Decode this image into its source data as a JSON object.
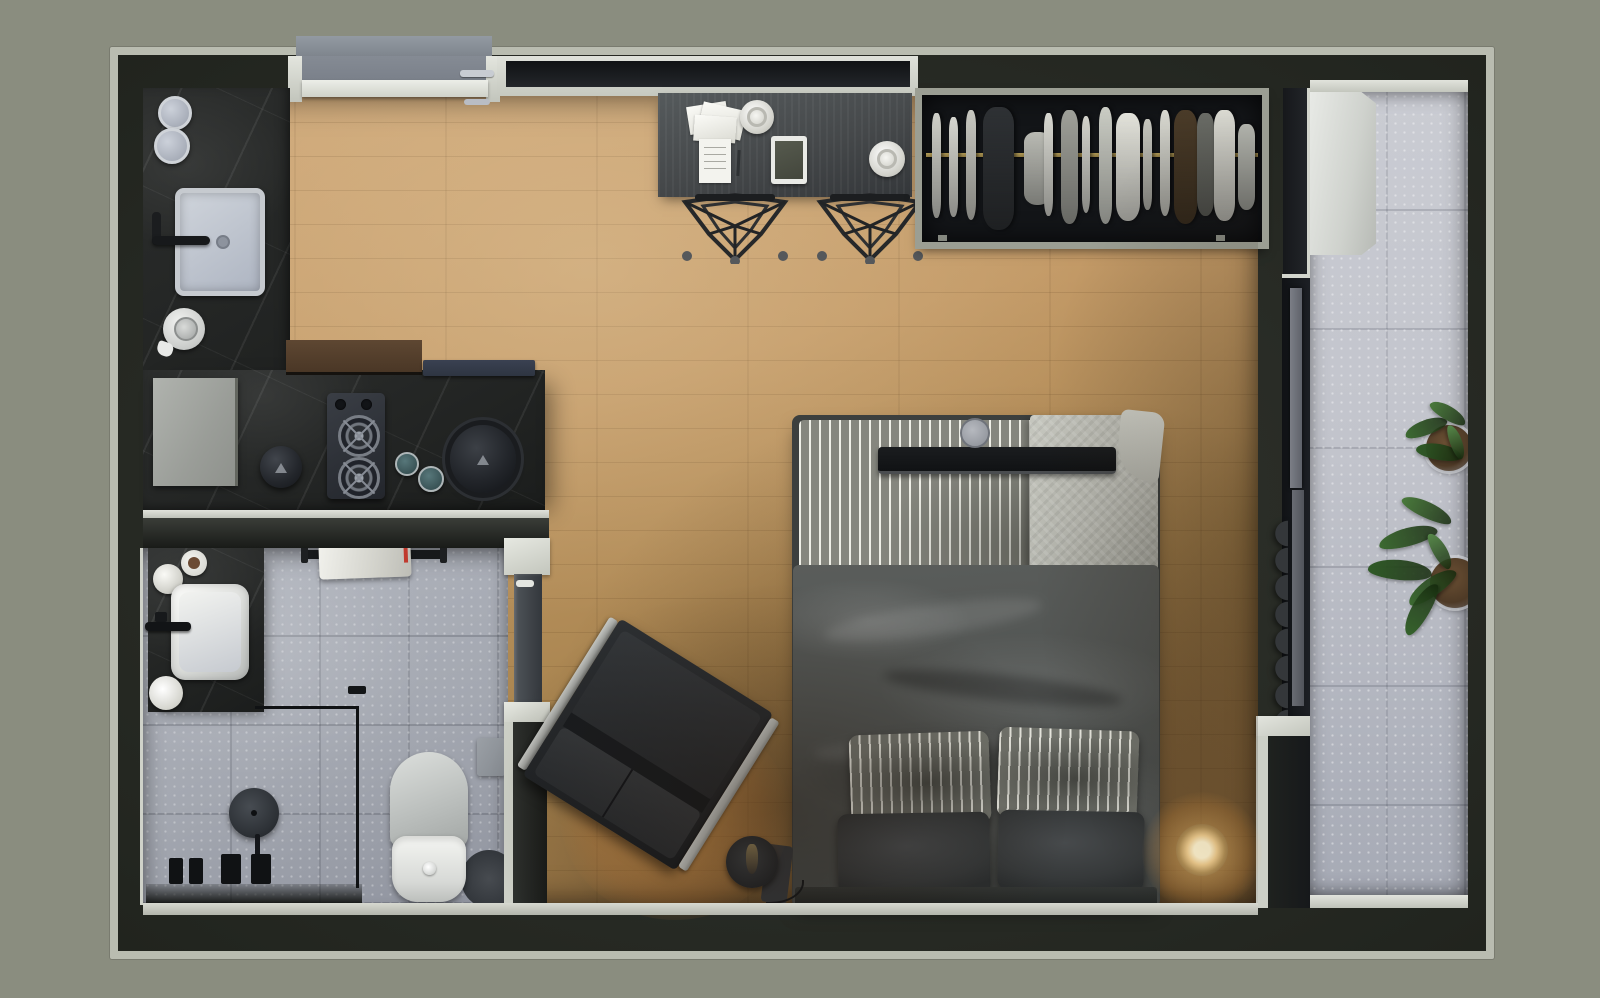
{
  "title": "Studio apartment floor plan — top-down 3D render",
  "palette": {
    "bg": "#8a8d7f",
    "trim": "#b9bcb0",
    "marble": "#232524",
    "marble_vein": "#ffffff12",
    "bath_tile": "#a4a8b1",
    "balc_tile": "#c2c4cc",
    "wood_a": "#cfa97a",
    "wood_b": "#a8844f",
    "wood_c": "#7d5f38",
    "desk": "#45484a",
    "navy": "#2e3542",
    "brass": "#8f7a42",
    "wardrobe_bg": "#131518",
    "duvet": "#4d504e",
    "sheet_light": "#eeeee6",
    "sheet_dark": "#85867e",
    "throw": "#b7b8b0",
    "pillow_dark": "#36393a",
    "leather": "#24272a",
    "metal": "#b3b5b1",
    "glow": "#ffcf7e",
    "soil": "#4e3a26",
    "red_tag": "#c03a2e"
  },
  "rooms": [
    {
      "id": "kitchen",
      "objects": [
        "marble-counter",
        "sink",
        "faucet",
        "cooktop-two-burners",
        "kettle",
        "canisters",
        "appliance",
        "serving-discs",
        "glasses"
      ]
    },
    {
      "id": "bathroom",
      "objects": [
        "marble-vanity",
        "vessel-sink",
        "black-faucet",
        "towel-rail",
        "towel",
        "walk-in-shower",
        "shower-head",
        "toilet",
        "toilet-rug",
        "paper-holder",
        "door"
      ]
    },
    {
      "id": "living-bedroom",
      "objects": [
        "desk",
        "papers",
        "coffee-cups",
        "notepad",
        "tablet",
        "two-wire-stools",
        "open-wardrobe",
        "hanging-clothes",
        "double-bed",
        "striped-sheet",
        "herringbone-throw",
        "bed-tray",
        "duvet",
        "four-pillows",
        "armchair",
        "floor-lamp",
        "table-lamp",
        "curtain",
        "sliding-glass-door"
      ]
    },
    {
      "id": "balcony",
      "objects": [
        "terrazzo-floor",
        "white-bench",
        "potted-plant",
        "potted-plant"
      ]
    },
    {
      "id": "entry",
      "objects": [
        "entry-door",
        "door-handles",
        "concrete-landing",
        "transom-window"
      ]
    }
  ],
  "wardrobe_clothes": [
    {
      "l": 3,
      "w": 2.5,
      "t": 12,
      "h": 72,
      "c": "#cfcfc8"
    },
    {
      "l": 8,
      "w": 2.5,
      "t": 15,
      "h": 68,
      "c": "#d6d6cf"
    },
    {
      "l": 13,
      "w": 3,
      "t": 10,
      "h": 75,
      "c": "#c8c8c0"
    },
    {
      "l": 18,
      "w": 9,
      "t": 8,
      "h": 84,
      "c": "#2e3134"
    },
    {
      "l": 30,
      "w": 8,
      "t": 25,
      "h": 50,
      "c": "#b9bab3"
    },
    {
      "l": 36,
      "w": 2.5,
      "t": 12,
      "h": 70,
      "c": "#d8d8d1"
    },
    {
      "l": 41,
      "w": 5,
      "t": 10,
      "h": 78,
      "c": "#9fa099"
    },
    {
      "l": 47,
      "w": 2.5,
      "t": 14,
      "h": 66,
      "c": "#d2d2cb"
    },
    {
      "l": 52,
      "w": 4,
      "t": 8,
      "h": 80,
      "c": "#caccc4"
    },
    {
      "l": 57,
      "w": 7,
      "t": 12,
      "h": 74,
      "c": "#e2e2da"
    },
    {
      "l": 65,
      "w": 2.5,
      "t": 16,
      "h": 62,
      "c": "#c5c5bd"
    },
    {
      "l": 70,
      "w": 3,
      "t": 10,
      "h": 72,
      "c": "#d8d8d0"
    },
    {
      "l": 74,
      "w": 7,
      "t": 10,
      "h": 78,
      "c": "#4a3b28"
    },
    {
      "l": 81,
      "w": 5,
      "t": 12,
      "h": 70,
      "c": "#6a6c66"
    },
    {
      "l": 86,
      "w": 6,
      "t": 10,
      "h": 76,
      "c": "#dcdcd4"
    },
    {
      "l": 93,
      "w": 5,
      "t": 20,
      "h": 58,
      "c": "#b4b6af"
    }
  ],
  "balcony_plants": {
    "pots": [
      {
        "x": 116,
        "y": 333,
        "d": 46
      },
      {
        "x": 120,
        "y": 466,
        "d": 50
      }
    ],
    "leaves": [
      {
        "x": 94,
        "y": 328,
        "w": 44,
        "h": 15,
        "r": -20,
        "c": "#3c6a31"
      },
      {
        "x": 118,
        "y": 314,
        "w": 40,
        "h": 14,
        "r": 30,
        "c": "#49793b"
      },
      {
        "x": 106,
        "y": 352,
        "w": 46,
        "h": 16,
        "r": 10,
        "c": "#2f5a26"
      },
      {
        "x": 128,
        "y": 344,
        "w": 36,
        "h": 12,
        "r": 70,
        "c": "#57884a"
      },
      {
        "x": 68,
        "y": 436,
        "w": 60,
        "h": 18,
        "r": -15,
        "c": "#3c6a31"
      },
      {
        "x": 90,
        "y": 410,
        "w": 54,
        "h": 16,
        "r": 25,
        "c": "#49793b"
      },
      {
        "x": 58,
        "y": 468,
        "w": 64,
        "h": 20,
        "r": 5,
        "c": "#2f5a26"
      },
      {
        "x": 94,
        "y": 486,
        "w": 56,
        "h": 18,
        "r": -35,
        "c": "#3c6a31"
      },
      {
        "x": 110,
        "y": 452,
        "w": 40,
        "h": 14,
        "r": 60,
        "c": "#57884a"
      },
      {
        "x": 82,
        "y": 508,
        "w": 58,
        "h": 18,
        "r": -60,
        "c": "#35622b"
      }
    ]
  }
}
